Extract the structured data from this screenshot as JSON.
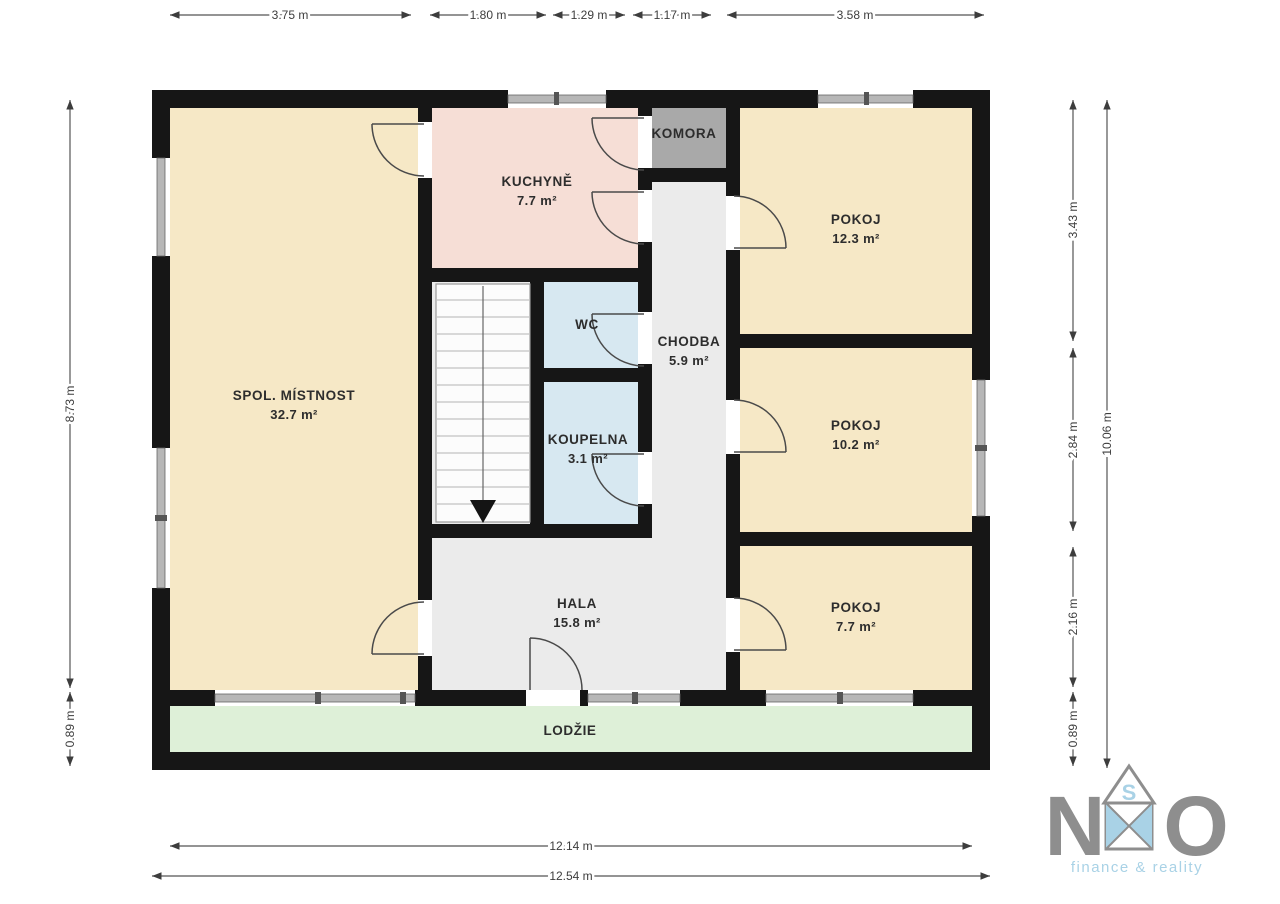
{
  "floorplan": {
    "rooms": {
      "spol": {
        "name": "SPOL. MÍSTNOST",
        "area": "32.7 m²"
      },
      "kuchyne": {
        "name": "KUCHYNĚ",
        "area": "7.7 m²"
      },
      "komora": {
        "name": "KOMORA"
      },
      "pokoj_a": {
        "name": "POKOJ",
        "area": "12.3 m²"
      },
      "wc": {
        "name": "WC"
      },
      "chodba": {
        "name": "CHODBA",
        "area": "5.9 m²"
      },
      "koupelna": {
        "name": "KOUPELNA",
        "area": "3.1 m²"
      },
      "pokoj_b": {
        "name": "POKOJ",
        "area": "10.2 m²"
      },
      "hala": {
        "name": "HALA",
        "area": "15.8 m²"
      },
      "pokoj_c": {
        "name": "POKOJ",
        "area": "7.7 m²"
      },
      "lodzie": {
        "name": "LODŽIE"
      }
    },
    "dimensions": {
      "top": [
        "3.75 m",
        "1.80 m",
        "1.29 m",
        "1.17 m",
        "3.58 m"
      ],
      "left": [
        "8.73 m",
        "0.89 m"
      ],
      "right_inner": [
        "3.43 m",
        "2.84 m",
        "2.16 m",
        "0.89 m"
      ],
      "right_outer": "10.06 m",
      "bottom": [
        "12.14 m",
        "12.54 m"
      ]
    },
    "colors": {
      "wall": "#161616",
      "beige": "#f6e8c6",
      "pink": "#f6ded6",
      "blue": "#d7e8f1",
      "gray_base": "#ebebeb",
      "gray_room": "#a9a9a9",
      "green": "#def0d8",
      "window": "#b7b7b7"
    }
  },
  "logo": {
    "letter_left": "N",
    "letter_right": "O",
    "roof_letter": "S",
    "tagline": "finance & reality",
    "letter_color": "#8e8e8e",
    "accent_color": "#a9d2e6"
  }
}
